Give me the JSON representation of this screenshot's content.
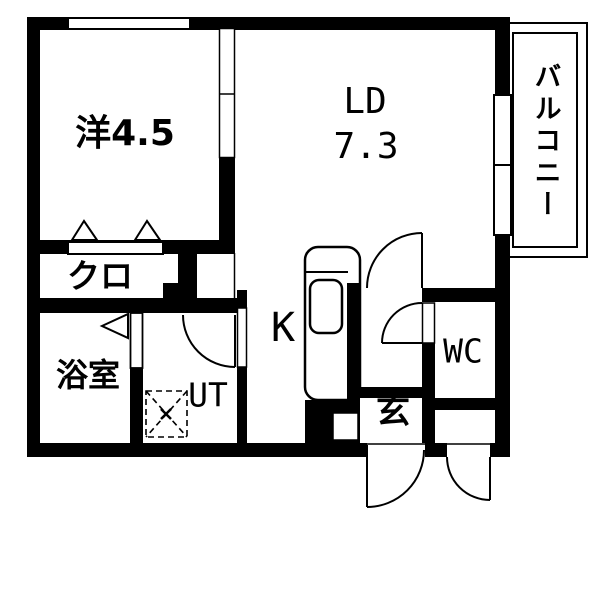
{
  "rooms": {
    "western_room": {
      "label": "洋4.5"
    },
    "living_dining": {
      "label": "LD",
      "area": "7.3"
    },
    "closet": {
      "label": "クロ"
    },
    "bathroom": {
      "label": "浴室"
    },
    "utility": {
      "label": "UT"
    },
    "kitchen": {
      "label": "K"
    },
    "entrance": {
      "label": "玄"
    },
    "toilet": {
      "label": "WC"
    },
    "balcony": {
      "label": "バルコニー"
    }
  },
  "fixtures": [
    "kitchen-counter-icon",
    "kitchen-sink-icon",
    "washing-machine-pan-icon",
    "hinged-door-arc-icon",
    "folding-door-triangle-icon",
    "sliding-partition-icon",
    "window-icon",
    "entrance-step-icon"
  ],
  "colors": {
    "wall": "#000000",
    "floor": "#ffffff",
    "line": "#000000"
  }
}
